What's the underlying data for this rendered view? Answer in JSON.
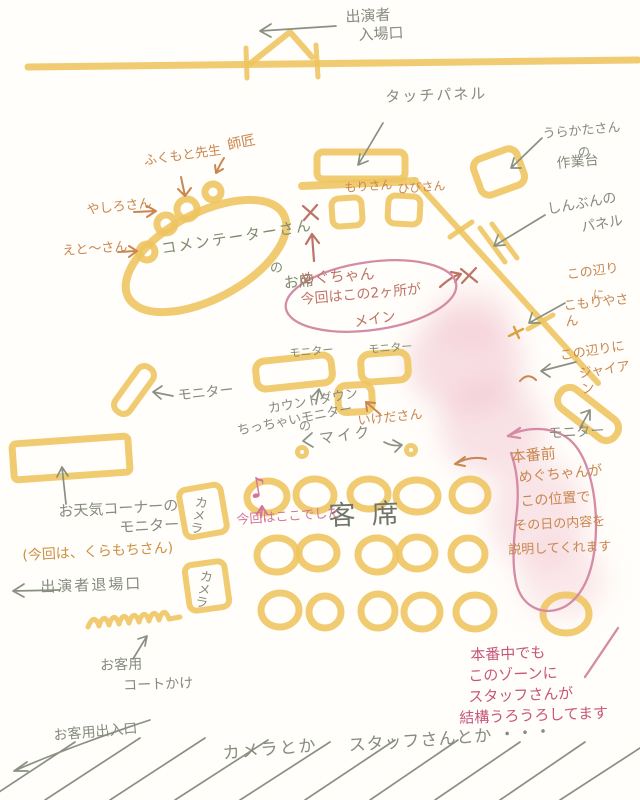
{
  "colors": {
    "marker_yellow": "#eec45f",
    "pencil_gray": "#8a9082",
    "pencil_green_gray": "#7f8a6e",
    "crayon_orange": "#c9864f",
    "crayon_brown_pink": "#bd7468",
    "crayon_pink": "#d2759a",
    "deep_pink": "#c6567e",
    "blob_pink": "#f0bfcc",
    "paper": "#fffefa"
  },
  "audience": {
    "rows": [
      5,
      5,
      6
    ]
  },
  "labels": {
    "performer_entrance": {
      "l1": "出演者",
      "l2": "入場口"
    },
    "touch_panel": "タッチパネル",
    "backstage_desk": {
      "l1": "うらかたさん",
      "l2": "の",
      "l3": "作業台"
    },
    "shimbun_panel": {
      "l1": "しんぶんの",
      "l2": "パネル"
    },
    "shisho": "師匠",
    "fukumoto": "ふくもと先生",
    "yashiro": "やしろさん",
    "eto": "えと〜さん",
    "commentator": {
      "l1": "コメンテーターさん",
      "l2": "の",
      "l3": "お席"
    },
    "mori": "もりさん",
    "hibi": "ひびさん",
    "megu_main": {
      "l1": "めぐちゃん",
      "l2": "今回はこの2ヶ所が",
      "l3": "メイン"
    },
    "komoriya": {
      "l1": "この辺り",
      "l2": "に",
      "l3": "こもりやさん"
    },
    "gian": {
      "l1": "この辺りに",
      "l2": "ジャイアン"
    },
    "monitor": "モニター",
    "countdown": {
      "l1": "カウントダウン",
      "l2": "の",
      "l3": "ちっちゃいモニター"
    },
    "ikeda": "いけださん",
    "mic": "マイク",
    "weather_monitor": "お天気コーナーの\nモニター",
    "weather_note": "(今回は、くらもちさん)",
    "performer_exit": "出演者退場口",
    "camera": "カメラ",
    "coat_rack": {
      "l1": "お客用",
      "l2": "コートかけ"
    },
    "seats": "客席",
    "here_this_time": "今回はここでした",
    "megu_explain": {
      "l1": "本番前",
      "l2": "めぐちゃんが",
      "l3": "この位置で",
      "l4": "その日の内容を",
      "l5": "説明してくれます"
    },
    "staff_zone": {
      "l1": "本番中でも",
      "l2": "このゾーンに",
      "l3": "スタッフさんが",
      "l4": "結構うろうろしてます"
    },
    "guest_entrance": "お客用出入口",
    "camera_etc": "カメラとか",
    "staff_etc": "スタッフさんとか ・・・",
    "music_note": "♪"
  }
}
